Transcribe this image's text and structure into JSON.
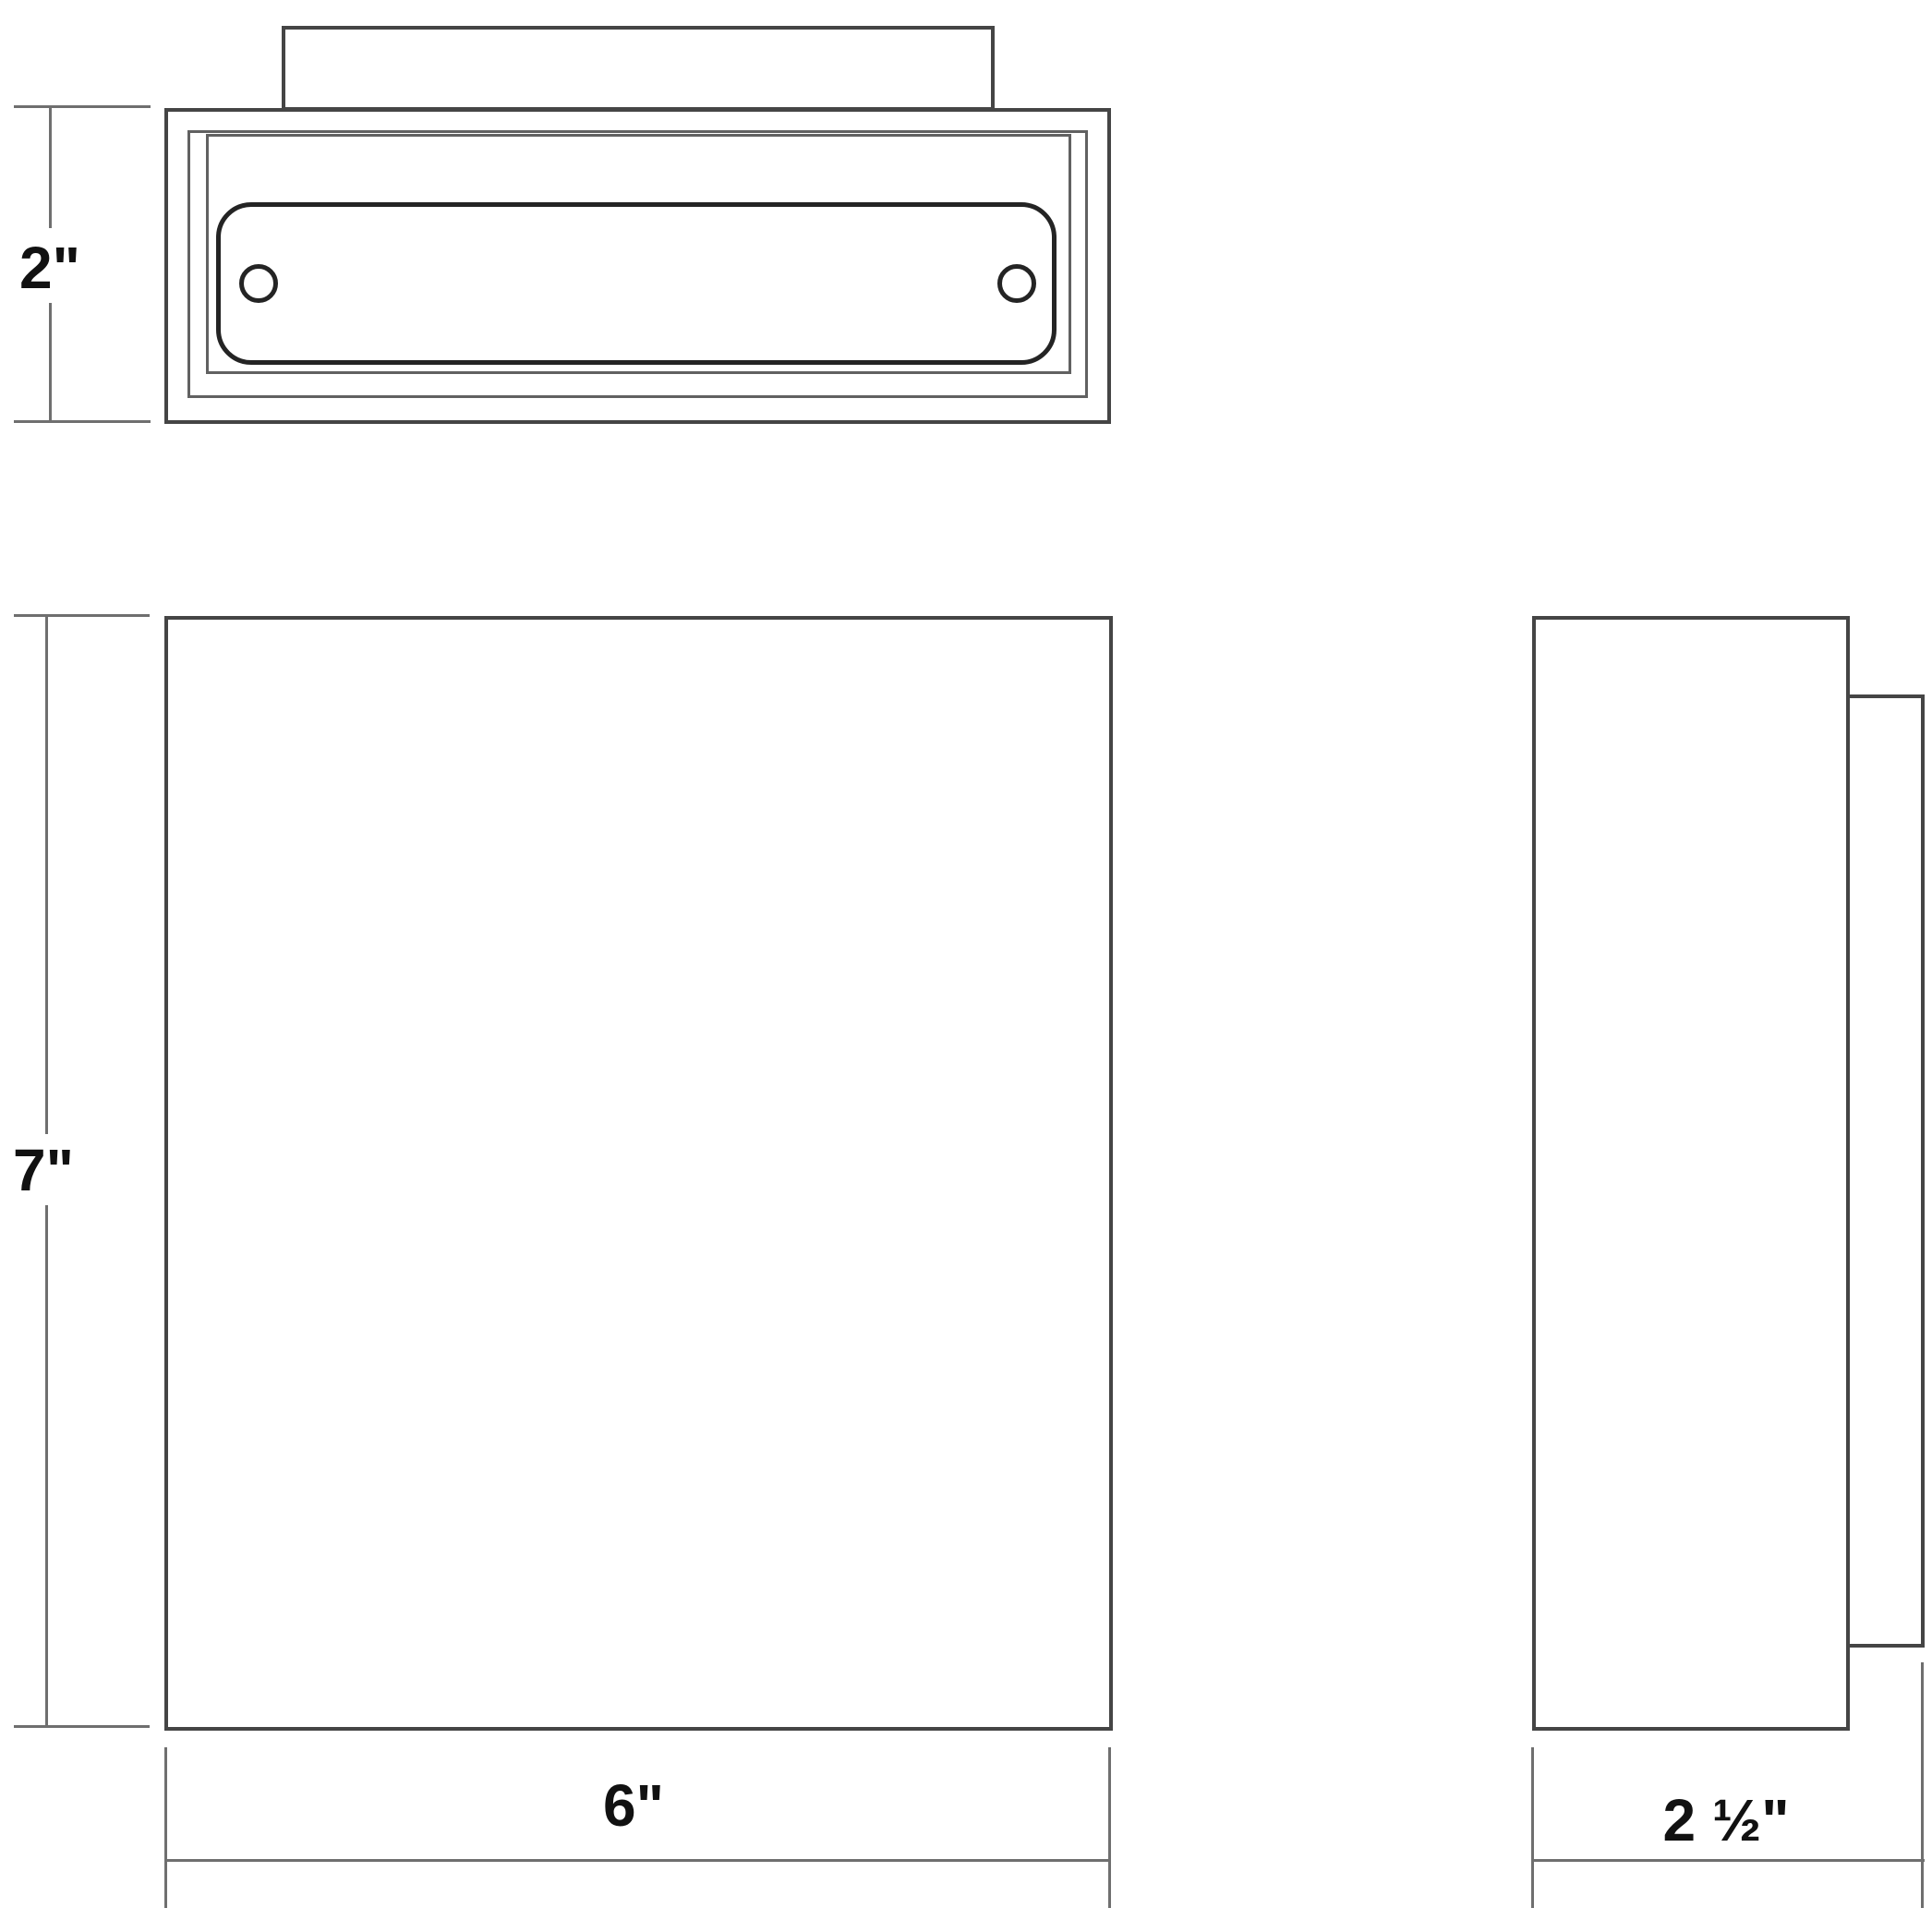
{
  "drawing": {
    "subject": "square wall light fixture dimension drawing"
  },
  "colors": {
    "background": "#ffffff",
    "object_line": "#454545",
    "lens_line": "#242424",
    "dimension_line": "#6f6f6f",
    "label_text": "#111111"
  },
  "dimensions": {
    "top_height": {
      "label": "2\""
    },
    "front_height": {
      "label": "7\""
    },
    "front_width": {
      "label": "6\""
    },
    "side_depth": {
      "label": "2 ½\""
    }
  }
}
